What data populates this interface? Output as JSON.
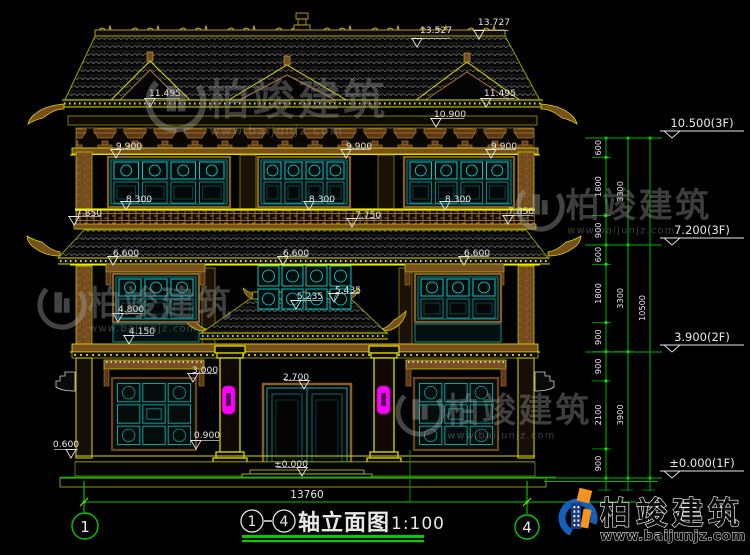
{
  "drawing_title": {
    "axis_start": "1",
    "axis_end": "4",
    "name": "轴立面图",
    "scale": "1:100"
  },
  "axis_bubbles": {
    "left": "1",
    "right": "4"
  },
  "overall_dimension": "13760",
  "spot_elevations": [
    {
      "label": "13.527",
      "x": 436,
      "y": 33,
      "tx": 417,
      "ty": 47
    },
    {
      "label": "13.727",
      "x": 494,
      "y": 25,
      "tx": 479,
      "ty": 39
    },
    {
      "label": "11.495",
      "x": 165,
      "y": 96,
      "tx": 150,
      "ty": 107
    },
    {
      "label": "11.495",
      "x": 500,
      "y": 96,
      "tx": 486,
      "ty": 107
    },
    {
      "label": "10.900",
      "x": 450,
      "y": 117,
      "tx": 436,
      "ty": 127
    },
    {
      "label": "9.900",
      "x": 129,
      "y": 149,
      "tx": 116,
      "ty": 158
    },
    {
      "label": "9.900",
      "x": 359,
      "y": 149,
      "tx": 346,
      "ty": 158
    },
    {
      "label": "9.900",
      "x": 504,
      "y": 149,
      "tx": 491,
      "ty": 158
    },
    {
      "label": "8.300",
      "x": 139,
      "y": 202,
      "tx": 126,
      "ty": 210
    },
    {
      "label": "8.300",
      "x": 322,
      "y": 202,
      "tx": 309,
      "ty": 210
    },
    {
      "label": "8.300",
      "x": 458,
      "y": 202,
      "tx": 445,
      "ty": 210
    },
    {
      "label": "7.850",
      "x": 89,
      "y": 216,
      "tx": 74,
      "ty": 225
    },
    {
      "label": "7.750",
      "x": 368,
      "y": 218,
      "tx": 352,
      "ty": 227
    },
    {
      "label": "7.850",
      "x": 521,
      "y": 214,
      "tx": 508,
      "ty": 224
    },
    {
      "label": "6.600",
      "x": 126,
      "y": 256,
      "tx": 113,
      "ty": 265
    },
    {
      "label": "6.600",
      "x": 296,
      "y": 256,
      "tx": 283,
      "ty": 265
    },
    {
      "label": "6.600",
      "x": 477,
      "y": 256,
      "tx": 464,
      "ty": 265
    },
    {
      "label": "5.435",
      "x": 348,
      "y": 293,
      "tx": 334,
      "ty": 302
    },
    {
      "label": "5.235",
      "x": 310,
      "y": 299,
      "tx": 296,
      "ty": 309
    },
    {
      "label": "4.800",
      "x": 131,
      "y": 312,
      "tx": 118,
      "ty": 322
    },
    {
      "label": "4.150",
      "x": 142,
      "y": 334,
      "tx": 129,
      "ty": 344
    },
    {
      "label": "3.000",
      "x": 205,
      "y": 373,
      "tx": 193,
      "ty": 382
    },
    {
      "label": "2.700",
      "x": 296,
      "y": 380,
      "tx": 304,
      "ty": 389
    },
    {
      "label": "0.900",
      "x": 207,
      "y": 438,
      "tx": 196,
      "ty": 449
    },
    {
      "label": "0.600",
      "x": 66,
      "y": 447,
      "tx": 71,
      "ty": 458
    },
    {
      "label": "±0.000",
      "x": 291,
      "y": 467,
      "tx": 302,
      "ty": 476
    }
  ],
  "level_markers": [
    {
      "label": "10.500(3F)",
      "level": 138
    },
    {
      "label": "7.200(3F)",
      "level": 245
    },
    {
      "label": "3.900(2F)",
      "level": 352
    },
    {
      "label": "±0.000(1F)",
      "level": 478
    }
  ],
  "dimension_chains": [
    {
      "x": 606,
      "segments": [
        {
          "label": "600",
          "from": 138,
          "to": 157.4
        },
        {
          "label": "1800",
          "from": 157.4,
          "to": 215.7
        },
        {
          "label": "900",
          "from": 215.7,
          "to": 244.9
        },
        {
          "label": "600",
          "from": 244.9,
          "to": 264.3
        },
        {
          "label": "1800",
          "from": 264.3,
          "to": 322.6
        },
        {
          "label": "900",
          "from": 322.6,
          "to": 351.7
        },
        {
          "label": "900",
          "from": 351.7,
          "to": 380.9
        },
        {
          "label": "2100",
          "from": 380.9,
          "to": 448.9
        },
        {
          "label": "900",
          "from": 448.9,
          "to": 478
        }
      ]
    },
    {
      "x": 628,
      "segments": [
        {
          "label": "3300",
          "from": 138,
          "to": 244.9
        },
        {
          "label": "3300",
          "from": 244.9,
          "to": 351.7
        },
        {
          "label": "3900",
          "from": 351.7,
          "to": 478
        }
      ]
    },
    {
      "x": 650,
      "segments": [
        {
          "label": "10500",
          "from": 138,
          "to": 478
        }
      ]
    }
  ],
  "watermark": {
    "company": "柏竣建筑",
    "url": "www.baijunjz.com",
    "instances": [
      {
        "x": 176,
        "y": 102,
        "s": 1.05
      },
      {
        "x": 540,
        "y": 207,
        "s": 0.85
      },
      {
        "x": 62,
        "y": 305,
        "s": 0.85
      },
      {
        "x": 420,
        "y": 412,
        "s": 0.85
      }
    ]
  },
  "brand_logo": {
    "company": "柏竣建筑",
    "url": "www.baijunjz.com"
  },
  "colors": {
    "background": "#000000",
    "cad_yellow": "#d8d800",
    "cad_bright_yellow": "#ffff00",
    "wood_brown": "#8a5c28",
    "lattice_cyan": "#00dede",
    "dim_green": "#00cc00",
    "tick_green": "#00ff00",
    "text_white": "#e8e8e8",
    "lamp_magenta": "#ff00ff",
    "logo_blue": "#1460b8",
    "logo_orange": "#f7941d"
  }
}
